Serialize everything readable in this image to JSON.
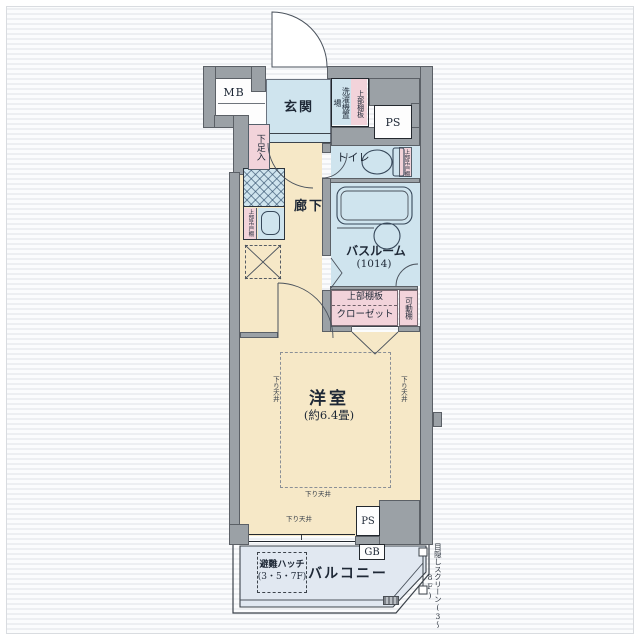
{
  "colors": {
    "wall": "#9ba1a6",
    "wet": "#cfe4ee",
    "floor": "#f6e8c7",
    "pink": "#f2d3da",
    "balcony": "#e1e8f1",
    "ink": "#1e2836"
  },
  "plan": {
    "entry": {
      "mb": "MB",
      "genkan": "玄関",
      "shoe_box": "下足入",
      "washer": "洗濯機置場",
      "washer_shelf": "上部棚板",
      "ps": "PS"
    },
    "wet_area": {
      "toilet": "トイレ",
      "toilet_shelf": "上部吊戸棚",
      "bath": "バスルーム",
      "bath_size": "(1014)"
    },
    "hall": {
      "label": "廊下",
      "kitchen_shelf": "上部吊戸棚"
    },
    "closet": {
      "shelf": "上部棚板",
      "label": "クローゼット",
      "movable": "可動棚"
    },
    "room": {
      "label": "洋室",
      "size": "(約6.4畳)",
      "ceiling": "下り天井",
      "ps": "PS"
    },
    "balcony": {
      "label": "バルコニー",
      "hatch": "避難ハッチ",
      "hatch_floors": "(3・5・7F)",
      "gb": "GB",
      "screen_note": "目隠しスクリーン(3〜8F)"
    }
  }
}
